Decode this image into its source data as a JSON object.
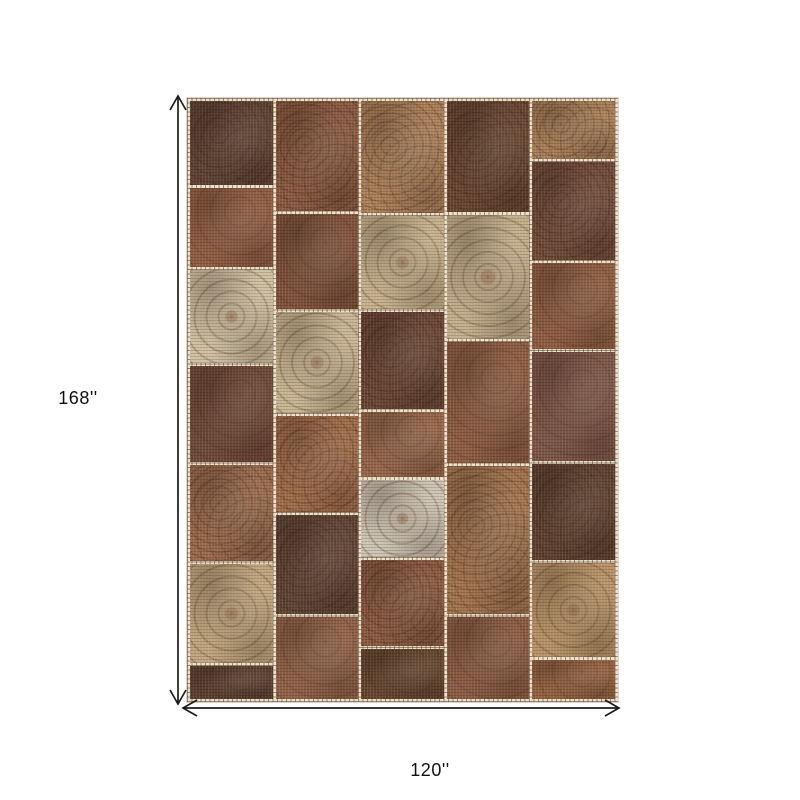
{
  "figure": {
    "height_label": "168''",
    "width_label": "120''",
    "arrow_color": "#1c1c1c",
    "background": "#ffffff"
  },
  "rug": {
    "description": "patchwork-rug-photo",
    "seam_color": "#ece2cb",
    "stitch_color": "#6b4a34",
    "columns": [
      {
        "patches": [
          {
            "h": 87,
            "color": "#5d4132",
            "motif": "floral"
          },
          {
            "h": 83,
            "color": "#8f5c41",
            "motif": "plain"
          },
          {
            "h": 97,
            "color": "#cec0a2",
            "motif": "medallion"
          },
          {
            "h": 100,
            "color": "#6e4837",
            "motif": "plain"
          },
          {
            "h": 100,
            "color": "#9a6a4b",
            "motif": "floral"
          },
          {
            "h": 103,
            "color": "#c0a67e",
            "motif": "medallion"
          },
          {
            "h": 34,
            "color": "#593e2f",
            "motif": "plain"
          }
        ]
      },
      {
        "patches": [
          {
            "h": 114,
            "color": "#8a5940",
            "motif": "floral"
          },
          {
            "h": 98,
            "color": "#7e513b",
            "motif": "plain"
          },
          {
            "h": 105,
            "color": "#c9b693",
            "motif": "medallion"
          },
          {
            "h": 100,
            "color": "#a06c49",
            "motif": "floral"
          },
          {
            "h": 102,
            "color": "#5f4334",
            "motif": "floral"
          },
          {
            "h": 85,
            "color": "#8f6046",
            "motif": "plain"
          }
        ]
      },
      {
        "patches": [
          {
            "h": 117,
            "color": "#ac8058",
            "motif": "floral"
          },
          {
            "h": 97,
            "color": "#c5b18c",
            "motif": "medallion"
          },
          {
            "h": 100,
            "color": "#694534",
            "motif": "floral"
          },
          {
            "h": 68,
            "color": "#956549",
            "motif": "plain"
          },
          {
            "h": 80,
            "color": "#cdc5b5",
            "motif": "medallion"
          },
          {
            "h": 90,
            "color": "#8a5940",
            "motif": "floral"
          },
          {
            "h": 52,
            "color": "#63442e",
            "motif": "plain"
          }
        ]
      },
      {
        "patches": [
          {
            "h": 114,
            "color": "#674531",
            "motif": "floral"
          },
          {
            "h": 128,
            "color": "#c3af8c",
            "motif": "medallion"
          },
          {
            "h": 125,
            "color": "#8d5c41",
            "motif": "plain"
          },
          {
            "h": 152,
            "color": "#a3744e",
            "motif": "floral"
          },
          {
            "h": 85,
            "color": "#8a5b42",
            "motif": "plain"
          }
        ]
      },
      {
        "patches": [
          {
            "h": 60,
            "color": "#a87e57",
            "motif": "floral"
          },
          {
            "h": 102,
            "color": "#6f4a39",
            "motif": "floral"
          },
          {
            "h": 90,
            "color": "#8d5c41",
            "motif": "plain"
          },
          {
            "h": 113,
            "color": "#7c5547",
            "motif": "plain"
          },
          {
            "h": 100,
            "color": "#5e4130",
            "motif": "floral"
          },
          {
            "h": 98,
            "color": "#b79266",
            "motif": "medallion"
          },
          {
            "h": 41,
            "color": "#92603f",
            "motif": "plain"
          }
        ]
      }
    ]
  }
}
